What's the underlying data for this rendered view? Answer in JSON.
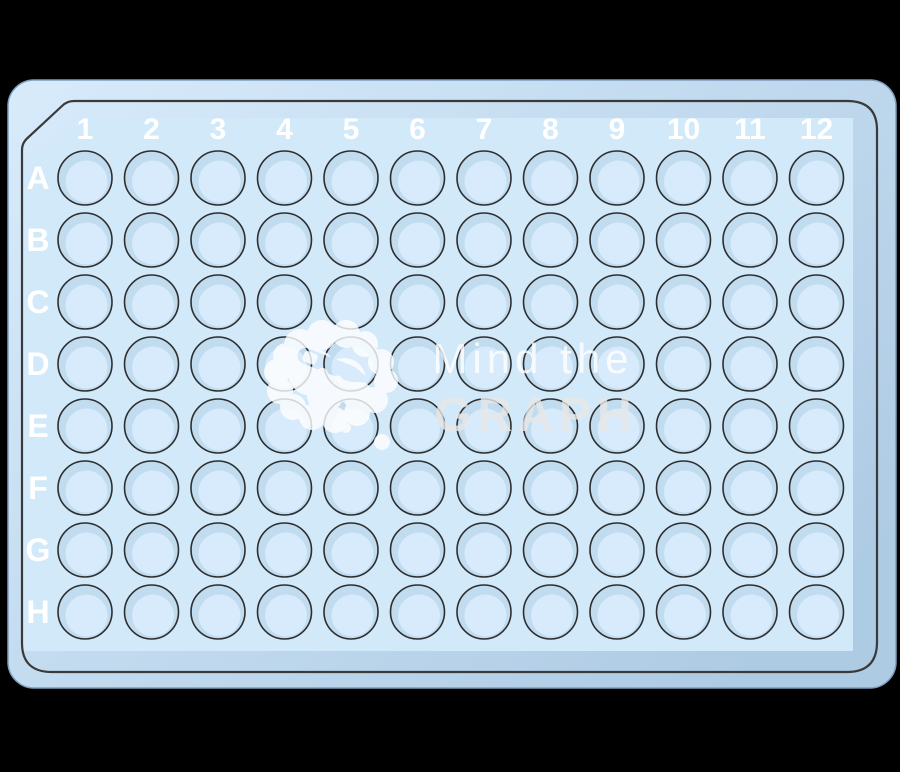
{
  "plate": {
    "kind": "96-well-microplate",
    "rows": 8,
    "columns": 12,
    "well_count": 96,
    "column_labels": [
      "1",
      "2",
      "3",
      "4",
      "5",
      "6",
      "7",
      "8",
      "9",
      "10",
      "11",
      "12"
    ],
    "row_labels": [
      "A",
      "B",
      "C",
      "D",
      "E",
      "F",
      "G",
      "H"
    ]
  },
  "watermark": {
    "line1": "Mind the",
    "line2": "GRAPH",
    "logo_icon": "cloud-pencil-icon"
  },
  "colors": {
    "background": "#000000",
    "plate_light": "#d8ebfb",
    "plate_dark": "#aecbe4",
    "panel": "#d2e9fa",
    "well_base": "#c1dcef",
    "well_inner": "#d7ebfc",
    "well_outline": "#2e2e2e",
    "skirt_outline": "#3a3a3a",
    "label_text": "#ffffff",
    "watermark_light": "#ffffff",
    "watermark_bold": "#e8e8e8"
  }
}
